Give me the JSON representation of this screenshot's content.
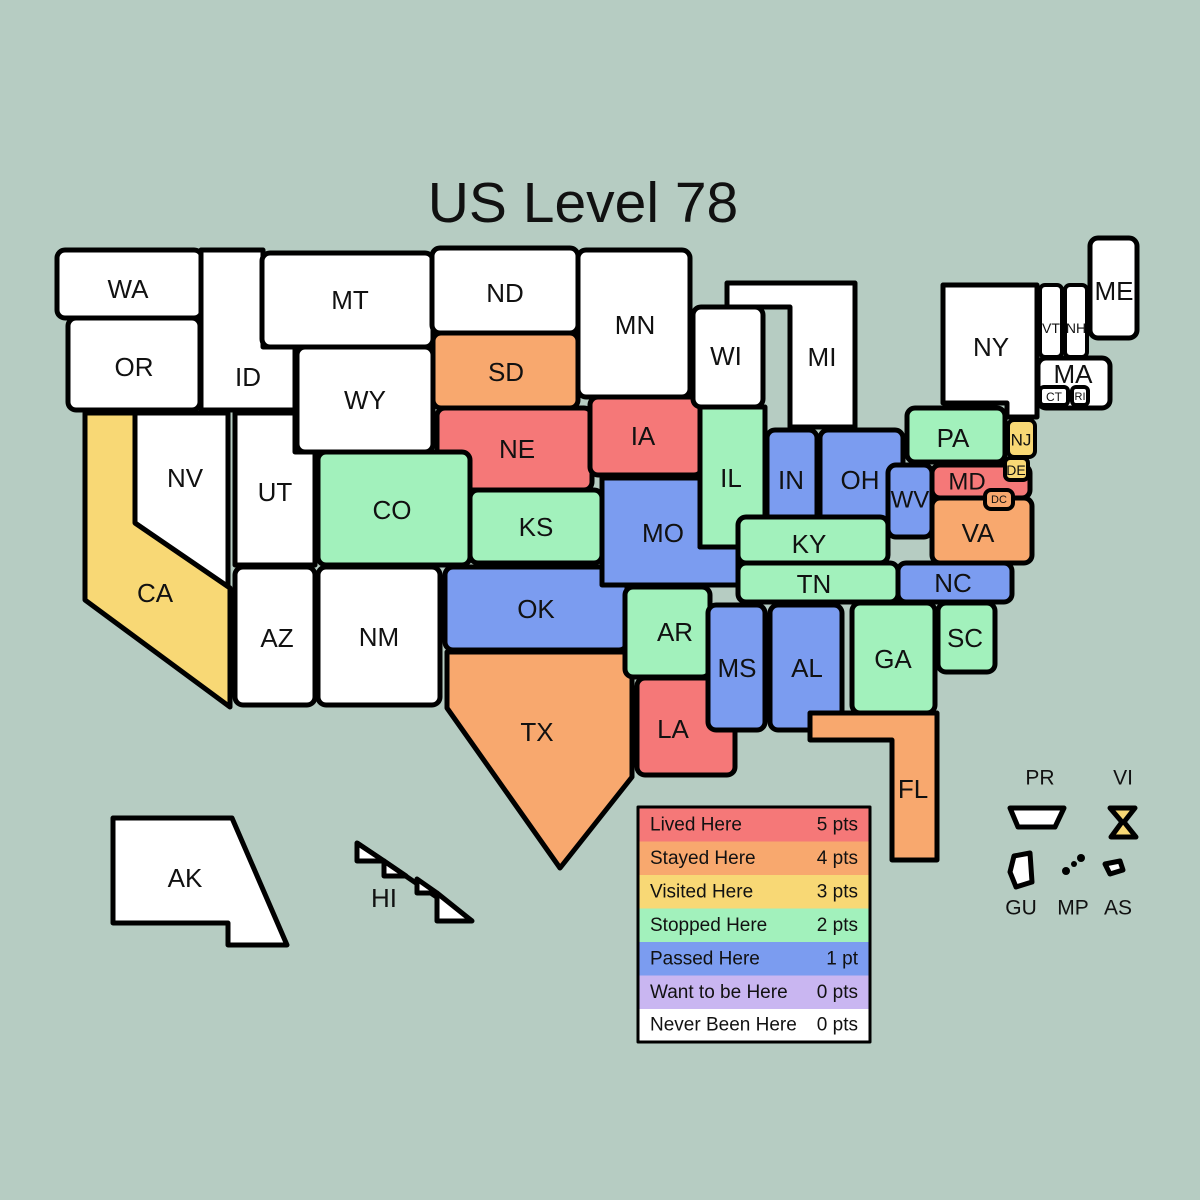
{
  "title": "US Level 78",
  "colors": {
    "background": "#b6ccc2",
    "stroke": "#000000",
    "lived": "#f57878",
    "stayed": "#f8a86e",
    "visited": "#f8d875",
    "stopped": "#a2f1bc",
    "passed": "#7b9cf0",
    "want": "#c9b6f1",
    "never": "#ffffff"
  },
  "legend": {
    "rows": [
      {
        "label": "Lived Here",
        "points": "5 pts",
        "color": "#f57878"
      },
      {
        "label": "Stayed Here",
        "points": "4 pts",
        "color": "#f8a86e"
      },
      {
        "label": "Visited Here",
        "points": "3 pts",
        "color": "#f8d875"
      },
      {
        "label": "Stopped Here",
        "points": "2 pts",
        "color": "#a2f1bc"
      },
      {
        "label": "Passed Here",
        "points": "1 pt",
        "color": "#7b9cf0"
      },
      {
        "label": "Want to be Here",
        "points": "0 pts",
        "color": "#c9b6f1"
      },
      {
        "label": "Never Been Here",
        "points": "0 pts",
        "color": "#ffffff"
      }
    ]
  },
  "states": {
    "WA": {
      "label": "WA",
      "status": "Never Been Here",
      "color": "#ffffff"
    },
    "OR": {
      "label": "OR",
      "status": "Never Been Here",
      "color": "#ffffff"
    },
    "ID": {
      "label": "ID",
      "status": "Never Been Here",
      "color": "#ffffff"
    },
    "MT": {
      "label": "MT",
      "status": "Never Been Here",
      "color": "#ffffff"
    },
    "WY": {
      "label": "WY",
      "status": "Never Been Here",
      "color": "#ffffff"
    },
    "NV": {
      "label": "NV",
      "status": "Never Been Here",
      "color": "#ffffff"
    },
    "UT": {
      "label": "UT",
      "status": "Never Been Here",
      "color": "#ffffff"
    },
    "CA": {
      "label": "CA",
      "status": "Visited Here",
      "color": "#f8d875"
    },
    "AZ": {
      "label": "AZ",
      "status": "Never Been Here",
      "color": "#ffffff"
    },
    "NM": {
      "label": "NM",
      "status": "Never Been Here",
      "color": "#ffffff"
    },
    "CO": {
      "label": "CO",
      "status": "Stopped Here",
      "color": "#a2f1bc"
    },
    "ND": {
      "label": "ND",
      "status": "Never Been Here",
      "color": "#ffffff"
    },
    "SD": {
      "label": "SD",
      "status": "Stayed Here",
      "color": "#f8a86e"
    },
    "NE": {
      "label": "NE",
      "status": "Lived Here",
      "color": "#f57878"
    },
    "KS": {
      "label": "KS",
      "status": "Stopped Here",
      "color": "#a2f1bc"
    },
    "OK": {
      "label": "OK",
      "status": "Passed Here",
      "color": "#7b9cf0"
    },
    "TX": {
      "label": "TX",
      "status": "Stayed Here",
      "color": "#f8a86e"
    },
    "MN": {
      "label": "MN",
      "status": "Never Been Here",
      "color": "#ffffff"
    },
    "IA": {
      "label": "IA",
      "status": "Lived Here",
      "color": "#f57878"
    },
    "MO": {
      "label": "MO",
      "status": "Passed Here",
      "color": "#7b9cf0"
    },
    "AR": {
      "label": "AR",
      "status": "Stopped Here",
      "color": "#a2f1bc"
    },
    "LA": {
      "label": "LA",
      "status": "Lived Here",
      "color": "#f57878"
    },
    "WI": {
      "label": "WI",
      "status": "Never Been Here",
      "color": "#ffffff"
    },
    "IL": {
      "label": "IL",
      "status": "Stopped Here",
      "color": "#a2f1bc"
    },
    "MI": {
      "label": "MI",
      "status": "Never Been Here",
      "color": "#ffffff"
    },
    "IN": {
      "label": "IN",
      "status": "Passed Here",
      "color": "#7b9cf0"
    },
    "OH": {
      "label": "OH",
      "status": "Passed Here",
      "color": "#7b9cf0"
    },
    "KY": {
      "label": "KY",
      "status": "Stopped Here",
      "color": "#a2f1bc"
    },
    "TN": {
      "label": "TN",
      "status": "Stopped Here",
      "color": "#a2f1bc"
    },
    "MS": {
      "label": "MS",
      "status": "Passed Here",
      "color": "#7b9cf0"
    },
    "AL": {
      "label": "AL",
      "status": "Passed Here",
      "color": "#7b9cf0"
    },
    "GA": {
      "label": "GA",
      "status": "Stopped Here",
      "color": "#a2f1bc"
    },
    "FL": {
      "label": "FL",
      "status": "Stayed Here",
      "color": "#f8a86e"
    },
    "SC": {
      "label": "SC",
      "status": "Stopped Here",
      "color": "#a2f1bc"
    },
    "NC": {
      "label": "NC",
      "status": "Passed Here",
      "color": "#7b9cf0"
    },
    "VA": {
      "label": "VA",
      "status": "Stayed Here",
      "color": "#f8a86e"
    },
    "WV": {
      "label": "WV",
      "status": "Passed Here",
      "color": "#7b9cf0"
    },
    "MD": {
      "label": "MD",
      "status": "Lived Here",
      "color": "#f57878"
    },
    "DC": {
      "label": "DC",
      "status": "Stayed Here",
      "color": "#f8a86e"
    },
    "DE": {
      "label": "DE",
      "status": "Visited Here",
      "color": "#f8d875"
    },
    "NJ": {
      "label": "NJ",
      "status": "Visited Here",
      "color": "#f8d875"
    },
    "PA": {
      "label": "PA",
      "status": "Stopped Here",
      "color": "#a2f1bc"
    },
    "NY": {
      "label": "NY",
      "status": "Never Been Here",
      "color": "#ffffff"
    },
    "VT": {
      "label": "VT",
      "status": "Never Been Here",
      "color": "#ffffff"
    },
    "NH": {
      "label": "NH",
      "status": "Never Been Here",
      "color": "#ffffff"
    },
    "ME": {
      "label": "ME",
      "status": "Never Been Here",
      "color": "#ffffff"
    },
    "MA": {
      "label": "MA",
      "status": "Never Been Here",
      "color": "#ffffff"
    },
    "CT": {
      "label": "CT",
      "status": "Never Been Here",
      "color": "#ffffff"
    },
    "RI": {
      "label": "RI",
      "status": "Never Been Here",
      "color": "#ffffff"
    },
    "AK": {
      "label": "AK",
      "status": "Never Been Here",
      "color": "#ffffff"
    },
    "HI": {
      "label": "HI",
      "status": "Never Been Here",
      "color": "#ffffff"
    }
  },
  "territories": {
    "PR": {
      "label": "PR",
      "status": "Never Been Here",
      "color": "#ffffff"
    },
    "VI": {
      "label": "VI",
      "status": "Visited Here",
      "color": "#f8d875"
    },
    "GU": {
      "label": "GU",
      "status": "Never Been Here",
      "color": "#ffffff"
    },
    "MP": {
      "label": "MP",
      "status": "Never Been Here",
      "color": "#000000"
    },
    "AS": {
      "label": "AS",
      "status": "Never Been Here",
      "color": "#ffffff"
    }
  }
}
